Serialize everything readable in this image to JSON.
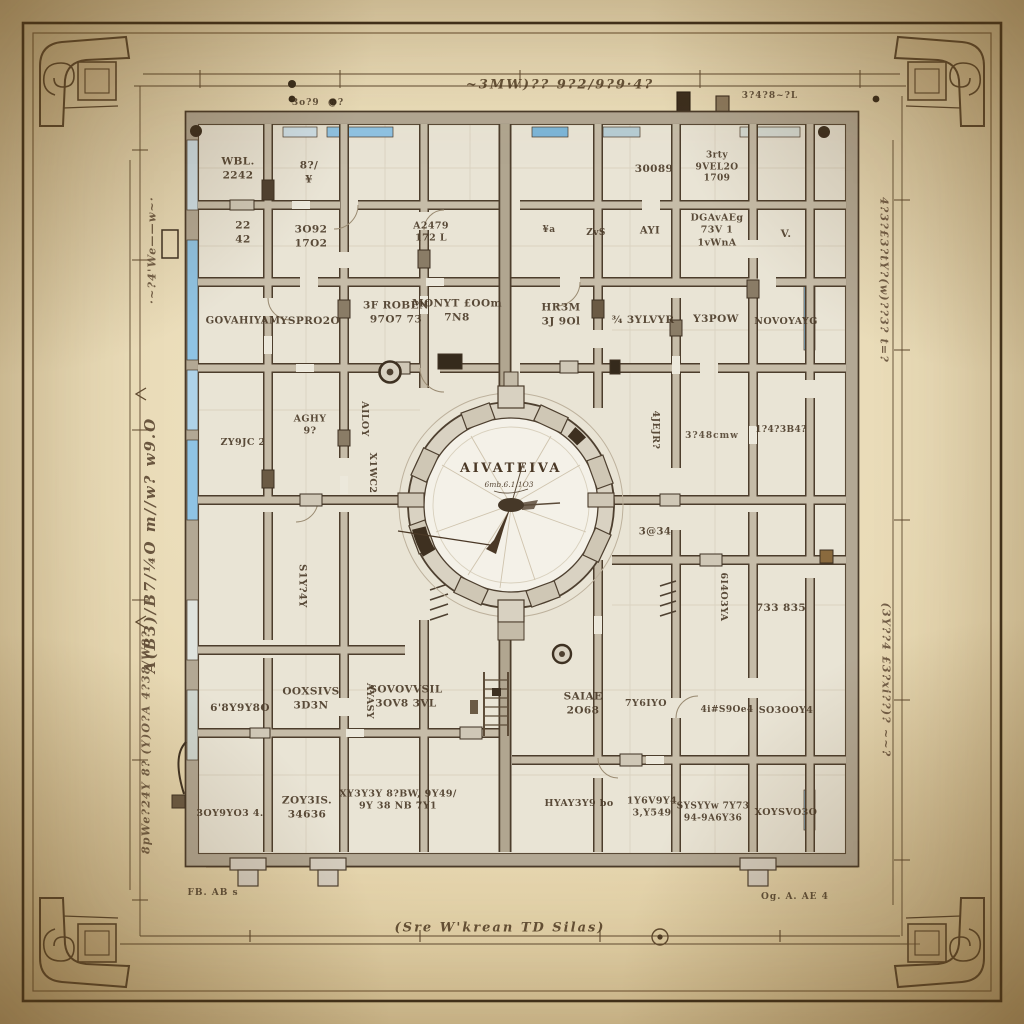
{
  "palette": {
    "parchment": "#eadcb8",
    "parchment_dark": "#a47e4c",
    "plan_paper": "#e9e4d5",
    "wall_fill": "#c6bca8",
    "ink": "#4c3d2c",
    "accent_blue": "#8fc3e3",
    "label_ink": "#4a3a28"
  },
  "clock": {
    "label": "AIVATEIVA",
    "sub_label": "6mb.6.1.1O3"
  },
  "labels": [
    {
      "t": "WBL.\n2242",
      "x": 238,
      "y": 169
    },
    {
      "t": "8?/\n¥",
      "x": 309,
      "y": 173
    },
    {
      "t": "30089",
      "x": 654,
      "y": 170
    },
    {
      "t": "3rty\n9VEL2O\n1709",
      "x": 717,
      "y": 168,
      "s": 9
    },
    {
      "t": "22\n42",
      "x": 243,
      "y": 233
    },
    {
      "t": "3O92\n17O2",
      "x": 311,
      "y": 237
    },
    {
      "t": "A2479\n172 L",
      "x": 431,
      "y": 233,
      "s": 9.5
    },
    {
      "t": "¥a",
      "x": 549,
      "y": 231,
      "s": 9
    },
    {
      "t": "ZvS",
      "x": 596,
      "y": 234,
      "s": 9
    },
    {
      "t": "AYI",
      "x": 650,
      "y": 231,
      "s": 10
    },
    {
      "t": "DGAvAEg\n73V 1\n1vWnA",
      "x": 717,
      "y": 231,
      "s": 9.5
    },
    {
      "t": "V.",
      "x": 786,
      "y": 235
    },
    {
      "t": "GOVAHIYAM",
      "x": 243,
      "y": 321,
      "s": 10
    },
    {
      "t": "YSPRO2O",
      "x": 310,
      "y": 322
    },
    {
      "t": "3F ROBEN\n97O7 73",
      "x": 396,
      "y": 313
    },
    {
      "t": "MONYT £OOm\n7N8",
      "x": 457,
      "y": 311
    },
    {
      "t": "HR3M\n3J 9Ol",
      "x": 561,
      "y": 315
    },
    {
      "t": "¾ 3YLVYR",
      "x": 643,
      "y": 321
    },
    {
      "t": "Y3POW",
      "x": 716,
      "y": 320
    },
    {
      "t": "NOVOYAYG",
      "x": 786,
      "y": 322,
      "s": 9.5
    },
    {
      "t": "AGHY\n9?",
      "x": 310,
      "y": 426,
      "s": 9.5
    },
    {
      "t": "ZY9JC 2",
      "x": 243,
      "y": 443,
      "s": 9.5
    },
    {
      "t": "AILOY",
      "x": 364,
      "y": 419,
      "rot": 90,
      "s": 9.5
    },
    {
      "t": "X1WC2",
      "x": 372,
      "y": 473,
      "rot": 90,
      "s": 9.5
    },
    {
      "t": "4JEJR?",
      "x": 655,
      "y": 430,
      "rot": 90,
      "s": 9.5
    },
    {
      "t": "3?48cmw",
      "x": 712,
      "y": 436,
      "cls": "note"
    },
    {
      "t": "1?4?3B4?",
      "x": 781,
      "y": 431,
      "s": 9
    },
    {
      "t": "3@34",
      "x": 655,
      "y": 532,
      "s": 10
    },
    {
      "t": "6I4O3YA",
      "x": 723,
      "y": 597,
      "rot": 90,
      "s": 9.5
    },
    {
      "t": "733 835",
      "x": 781,
      "y": 609
    },
    {
      "t": "S1Y?4Y",
      "x": 302,
      "y": 586,
      "rot": 90,
      "s": 10
    },
    {
      "t": "AYASY",
      "x": 369,
      "y": 701,
      "rot": 90,
      "s": 9.5
    },
    {
      "t": "6'8Y9Y8O",
      "x": 240,
      "y": 709
    },
    {
      "t": "OOXSIVS\n3D3N",
      "x": 311,
      "y": 699
    },
    {
      "t": "SOVOVVSIL\n3OV8 3VL",
      "x": 406,
      "y": 697
    },
    {
      "t": "SAIAE\n2O68",
      "x": 583,
      "y": 704
    },
    {
      "t": "7Y6IYO",
      "x": 646,
      "y": 704,
      "s": 9.5
    },
    {
      "t": "4i#S9Oe4",
      "x": 727,
      "y": 711,
      "s": 9
    },
    {
      "t": "SO3OOY4",
      "x": 786,
      "y": 711,
      "s": 9.5
    },
    {
      "t": "3OY9YO3 4.",
      "x": 230,
      "y": 814,
      "s": 9.5
    },
    {
      "t": "ZOY3IS.\n34636",
      "x": 307,
      "y": 808
    },
    {
      "t": "XY3Y3Y 8?BW, 9Y49/\n9Y 38 NB   7Y1",
      "x": 398,
      "y": 801,
      "s": 9.5
    },
    {
      "t": "HYAY3Y9 bo",
      "x": 579,
      "y": 804,
      "s": 9.5
    },
    {
      "t": "1Y6V9Y4\n3,Y549",
      "x": 652,
      "y": 808,
      "s": 9.5
    },
    {
      "t": "SYSYYw 7Y73\n94-9A6Y36",
      "x": 713,
      "y": 813,
      "s": 9
    },
    {
      "t": "XOYSVO3O",
      "x": 786,
      "y": 813,
      "s": 9.5
    },
    {
      "t": "·~?4'We——w~·",
      "x": 152,
      "y": 250,
      "rot": -90,
      "cls": "ann",
      "name": "annotation"
    },
    {
      "t": "A(B3)/B7/¼O m//w? w9.O",
      "x": 150,
      "y": 545,
      "rot": -90,
      "cls": "ann big",
      "name": "annotation"
    },
    {
      "t": "8pWe?24Y 8? (Y)O?A 4?38/W8?",
      "x": 146,
      "y": 742,
      "rot": -90,
      "cls": "ann",
      "name": "annotation"
    },
    {
      "t": "4?3?£3?tY?(w)??3? t=?",
      "x": 884,
      "y": 280,
      "rot": 90,
      "cls": "ann",
      "name": "annotation"
    },
    {
      "t": "(3Y??4 £3?xi??)? ~~?",
      "x": 886,
      "y": 680,
      "rot": 90,
      "cls": "ann",
      "name": "annotation"
    },
    {
      "t": "~3MW)?? 9?2/9?9·4?",
      "x": 560,
      "y": 85,
      "cls": "script",
      "name": "script-note"
    },
    {
      "t": "3?4?8~?L",
      "x": 770,
      "y": 96,
      "cls": "note",
      "name": "script-note"
    },
    {
      "t": "3o?9  @?",
      "x": 318,
      "y": 103,
      "cls": "note",
      "name": "script-note"
    },
    {
      "t": "(Sre W'krean TD Silas)",
      "x": 500,
      "y": 928,
      "cls": "script",
      "name": "script-note"
    },
    {
      "t": "FB. AB s",
      "x": 213,
      "y": 893,
      "cls": "note",
      "name": "corner-note"
    },
    {
      "t": "Og. A. AE 4",
      "x": 795,
      "y": 897,
      "cls": "note",
      "name": "corner-note"
    }
  ]
}
